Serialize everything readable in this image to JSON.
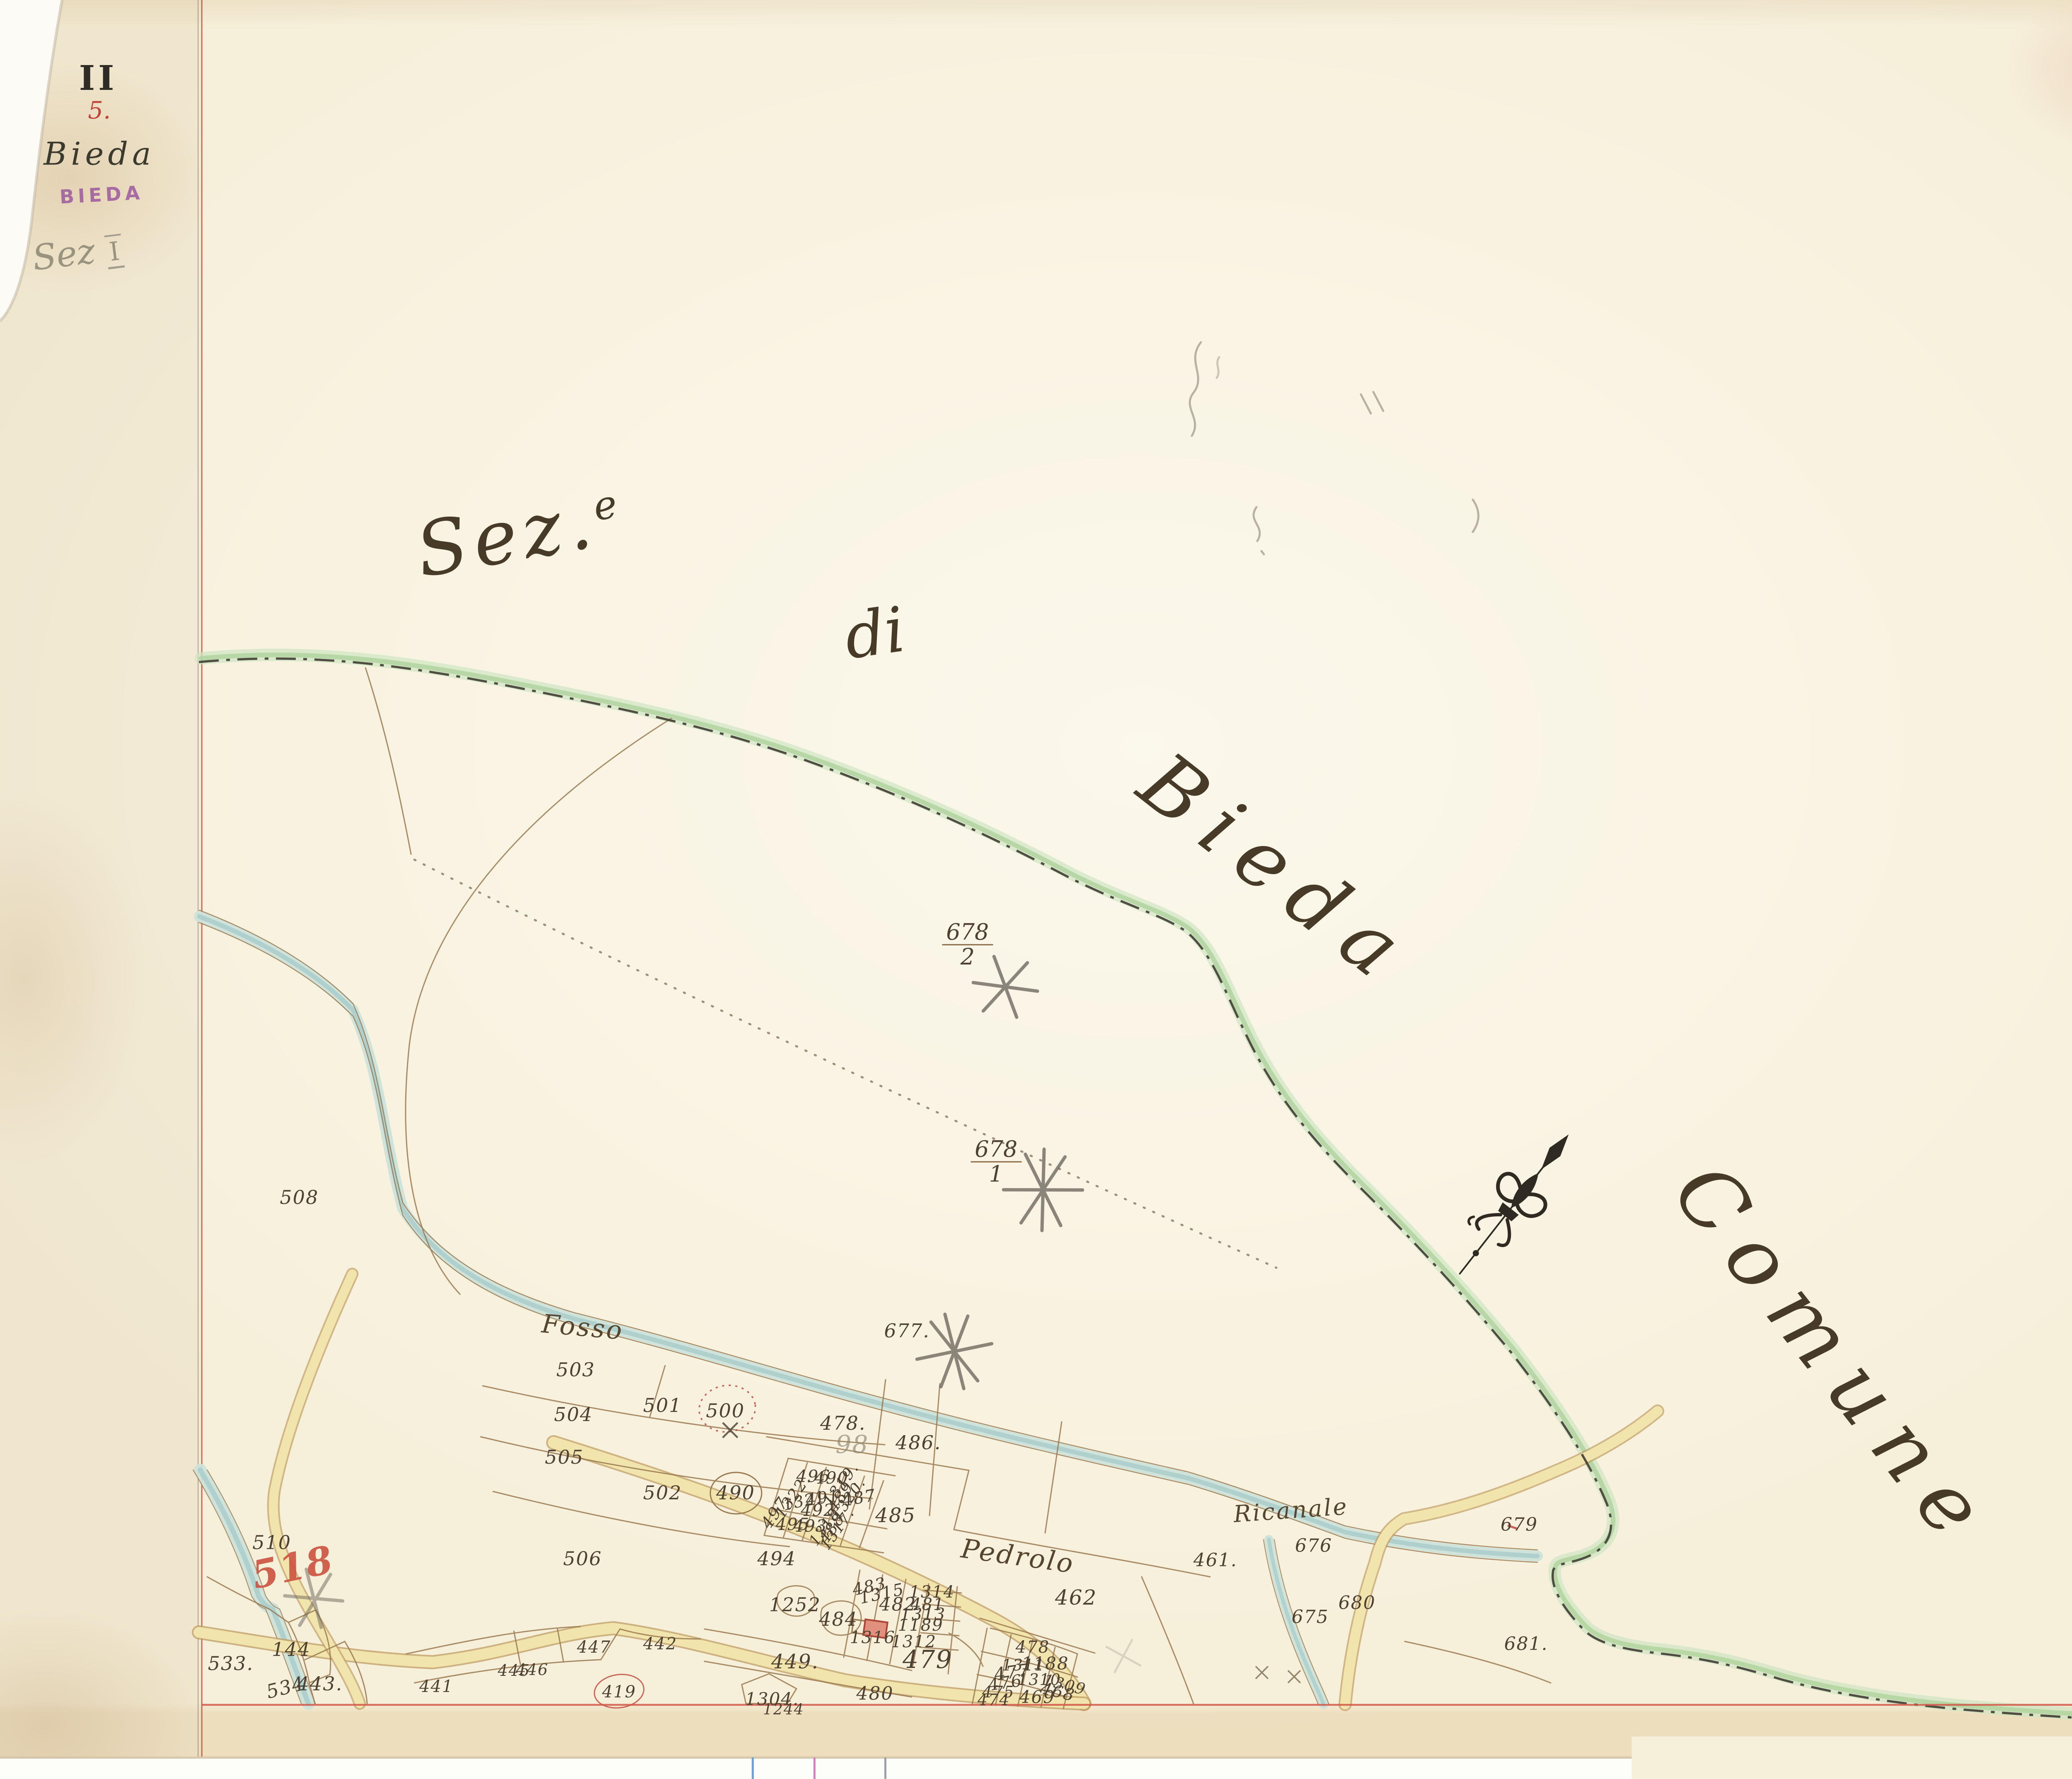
{
  "header": {
    "volume_roman": "II",
    "sheet_number": "5.",
    "title_script": "Bieda",
    "stamp": "BIEDA",
    "pencil_note_script": "Sez",
    "pencil_note_numeral": "I"
  },
  "map_titles": {
    "section_word": "Sez.",
    "section_sup": "e",
    "connector": "di",
    "territory": "Bieda",
    "neighbour_text": "Comune"
  },
  "place_labels": [
    {
      "text": "Fosso",
      "x": 25.5,
      "y": 74.6,
      "r": 5,
      "s": 62
    },
    {
      "text": "Ricanale",
      "x": 56.5,
      "y": 84.9,
      "r": -4,
      "s": 56
    },
    {
      "text": "Pedrolo",
      "x": 44.55,
      "y": 87.5,
      "r": 8,
      "s": 64
    }
  ],
  "survey_fractions": [
    {
      "numerator": "678",
      "denominator": "2",
      "x": 42.35,
      "y": 53.1
    },
    {
      "numerator": "678",
      "denominator": "1",
      "x": 43.6,
      "y": 65.3
    }
  ],
  "parcel_numbers": [
    {
      "t": "508",
      "x": 13.1,
      "y": 67.3
    },
    {
      "t": "677.",
      "x": 39.7,
      "y": 74.8
    },
    {
      "t": "510",
      "x": 11.9,
      "y": 86.7
    },
    {
      "t": "518",
      "x": 12.8,
      "y": 88.1,
      "r": -12,
      "s": 92,
      "c": "red-crayon"
    },
    {
      "t": "533.",
      "x": 10.1,
      "y": 93.5
    },
    {
      "t": "144",
      "x": 12.75,
      "y": 92.7
    },
    {
      "t": "534",
      "x": 12.5,
      "y": 94.85,
      "r": -14
    },
    {
      "t": "443.",
      "x": 14.0,
      "y": 94.65
    },
    {
      "t": "441",
      "x": 19.1,
      "y": 94.8,
      "s": 40
    },
    {
      "t": "445",
      "x": 22.5,
      "y": 93.9,
      "s": 38
    },
    {
      "t": "446",
      "x": 23.3,
      "y": 93.85,
      "s": 38
    },
    {
      "t": "447",
      "x": 26.0,
      "y": 92.6,
      "s": 40
    },
    {
      "t": "442",
      "x": 28.9,
      "y": 92.4,
      "s": 40
    },
    {
      "t": "419",
      "x": 27.1,
      "y": 95.1,
      "s": 40
    },
    {
      "t": "1244",
      "x": 34.3,
      "y": 96.1,
      "s": 36
    },
    {
      "t": "503",
      "x": 25.2,
      "y": 77.0
    },
    {
      "t": "504",
      "x": 25.1,
      "y": 79.5
    },
    {
      "t": "505",
      "x": 24.7,
      "y": 81.9
    },
    {
      "t": "506",
      "x": 25.5,
      "y": 87.6
    },
    {
      "t": "502",
      "x": 29.0,
      "y": 83.9
    },
    {
      "t": "490",
      "x": 32.2,
      "y": 83.9
    },
    {
      "t": "501",
      "x": 29.0,
      "y": 79.0
    },
    {
      "t": "500",
      "x": 31.75,
      "y": 79.3
    },
    {
      "t": "478.",
      "x": 36.9,
      "y": 80.0
    },
    {
      "t": "98",
      "x": 37.3,
      "y": 81.2,
      "s": 60,
      "c": "pencil"
    },
    {
      "t": "486.",
      "x": 40.2,
      "y": 81.1
    },
    {
      "t": "496",
      "x": 35.6,
      "y": 83.0,
      "s": 40
    },
    {
      "t": "490",
      "x": 36.4,
      "y": 83.1,
      "s": 40
    },
    {
      "t": "1319.",
      "x": 36.8,
      "y": 83.45,
      "r": -55,
      "s": 38
    },
    {
      "t": "1322.",
      "x": 34.7,
      "y": 84.1,
      "r": -55,
      "s": 38
    },
    {
      "t": "1321",
      "x": 35.2,
      "y": 84.35,
      "r": -12,
      "s": 38
    },
    {
      "t": "491",
      "x": 36.0,
      "y": 84.2,
      "r": -8,
      "s": 40
    },
    {
      "t": "489.",
      "x": 36.85,
      "y": 84.0,
      "r": -55,
      "s": 38
    },
    {
      "t": "1320.",
      "x": 37.15,
      "y": 84.25,
      "r": -55,
      "s": 36
    },
    {
      "t": "487",
      "x": 37.6,
      "y": 84.2,
      "r": -10,
      "s": 40
    },
    {
      "t": "492",
      "x": 35.8,
      "y": 84.9,
      "s": 40
    },
    {
      "t": "497.",
      "x": 34.0,
      "y": 84.9,
      "r": -55,
      "s": 40
    },
    {
      "t": "495",
      "x": 34.7,
      "y": 85.7,
      "s": 40
    },
    {
      "t": "493.",
      "x": 35.6,
      "y": 85.8,
      "s": 40
    },
    {
      "t": "1318",
      "x": 36.1,
      "y": 85.85,
      "r": -55,
      "s": 36
    },
    {
      "t": "488",
      "x": 36.4,
      "y": 85.9,
      "r": -55,
      "s": 38
    },
    {
      "t": "1317.",
      "x": 36.65,
      "y": 85.95,
      "r": -55,
      "s": 36
    },
    {
      "t": "485",
      "x": 39.2,
      "y": 85.2,
      "s": 48
    },
    {
      "t": "494",
      "x": 34.0,
      "y": 87.6
    },
    {
      "t": "1252",
      "x": 34.8,
      "y": 90.2
    },
    {
      "t": "484",
      "x": 36.7,
      "y": 91.0
    },
    {
      "t": "483",
      "x": 38.05,
      "y": 89.2,
      "r": -12,
      "s": 40
    },
    {
      "t": "1315",
      "x": 38.6,
      "y": 89.6,
      "r": -12,
      "s": 40
    },
    {
      "t": "482",
      "x": 39.3,
      "y": 90.2,
      "s": 44
    },
    {
      "t": "1314",
      "x": 40.8,
      "y": 89.5,
      "s": 40
    },
    {
      "t": "481",
      "x": 40.6,
      "y": 90.2,
      "s": 40
    },
    {
      "t": "1313",
      "x": 40.4,
      "y": 90.75,
      "s": 40
    },
    {
      "t": "1189",
      "x": 40.3,
      "y": 91.35,
      "s": 40
    },
    {
      "t": "1312",
      "x": 40.0,
      "y": 92.3,
      "s": 40
    },
    {
      "t": "1316",
      "x": 38.2,
      "y": 92.05,
      "s": 40
    },
    {
      "t": "449.",
      "x": 34.8,
      "y": 93.4,
      "s": 48
    },
    {
      "t": "1304.",
      "x": 33.8,
      "y": 95.5,
      "s": 42
    },
    {
      "t": "480",
      "x": 38.3,
      "y": 95.2,
      "s": 44
    },
    {
      "t": "479",
      "x": 40.6,
      "y": 93.3,
      "s": 60
    },
    {
      "t": "462",
      "x": 47.1,
      "y": 89.8,
      "s": 50
    },
    {
      "t": "478",
      "x": 45.2,
      "y": 92.6,
      "s": 40
    },
    {
      "t": "1188",
      "x": 45.75,
      "y": 93.5,
      "s": 42
    },
    {
      "t": "1311",
      "x": 44.8,
      "y": 93.6,
      "s": 38
    },
    {
      "t": "477",
      "x": 44.3,
      "y": 94.0,
      "r": -8,
      "s": 42
    },
    {
      "t": "1310",
      "x": 45.5,
      "y": 94.4,
      "s": 38
    },
    {
      "t": "476",
      "x": 44.0,
      "y": 94.6,
      "r": -8,
      "s": 40
    },
    {
      "t": "1309",
      "x": 46.6,
      "y": 94.7,
      "r": 14,
      "s": 38
    },
    {
      "t": "475",
      "x": 43.7,
      "y": 95.1,
      "s": 38
    },
    {
      "t": "468",
      "x": 46.3,
      "y": 95.1,
      "r": 14,
      "s": 40
    },
    {
      "t": "469",
      "x": 45.4,
      "y": 95.4,
      "s": 42
    },
    {
      "t": "474",
      "x": 43.5,
      "y": 95.55,
      "s": 38
    },
    {
      "t": "461.",
      "x": 53.2,
      "y": 87.7,
      "s": 44
    },
    {
      "t": "676",
      "x": 57.5,
      "y": 86.9,
      "s": 44
    },
    {
      "t": "675",
      "x": 57.35,
      "y": 90.9,
      "s": 44
    },
    {
      "t": "680",
      "x": 59.4,
      "y": 90.1,
      "s": 44
    },
    {
      "t": "679",
      "x": 66.5,
      "y": 85.7,
      "s": 44
    },
    {
      "t": "681.",
      "x": 66.8,
      "y": 92.4,
      "s": 44
    }
  ],
  "bottom_edge_ticks": [
    {
      "x": 32.9,
      "color": "#6f9fd8"
    },
    {
      "x": 35.6,
      "color": "#d583c0"
    },
    {
      "x": 38.7,
      "color": "#9aa0a8"
    }
  ],
  "colors": {
    "paper": "#f6efd9",
    "ink": "#4f4132",
    "line": "#9b7a50",
    "red": "#c0453a",
    "red-crayon": "#cc5240",
    "stamp": "#96519b",
    "pencil": "#85806f",
    "water": "#a9cdc9",
    "water-light": "#cde2da",
    "road-fill": "#f1e5ad",
    "road-edge": "#c09c62",
    "green-band": "#b7d8a6",
    "boundary-ink": "#403c34",
    "neatline-red": "#c84b3c"
  },
  "compass": {
    "type": "fleur-de-lis north arrow",
    "direction": "north-east"
  }
}
